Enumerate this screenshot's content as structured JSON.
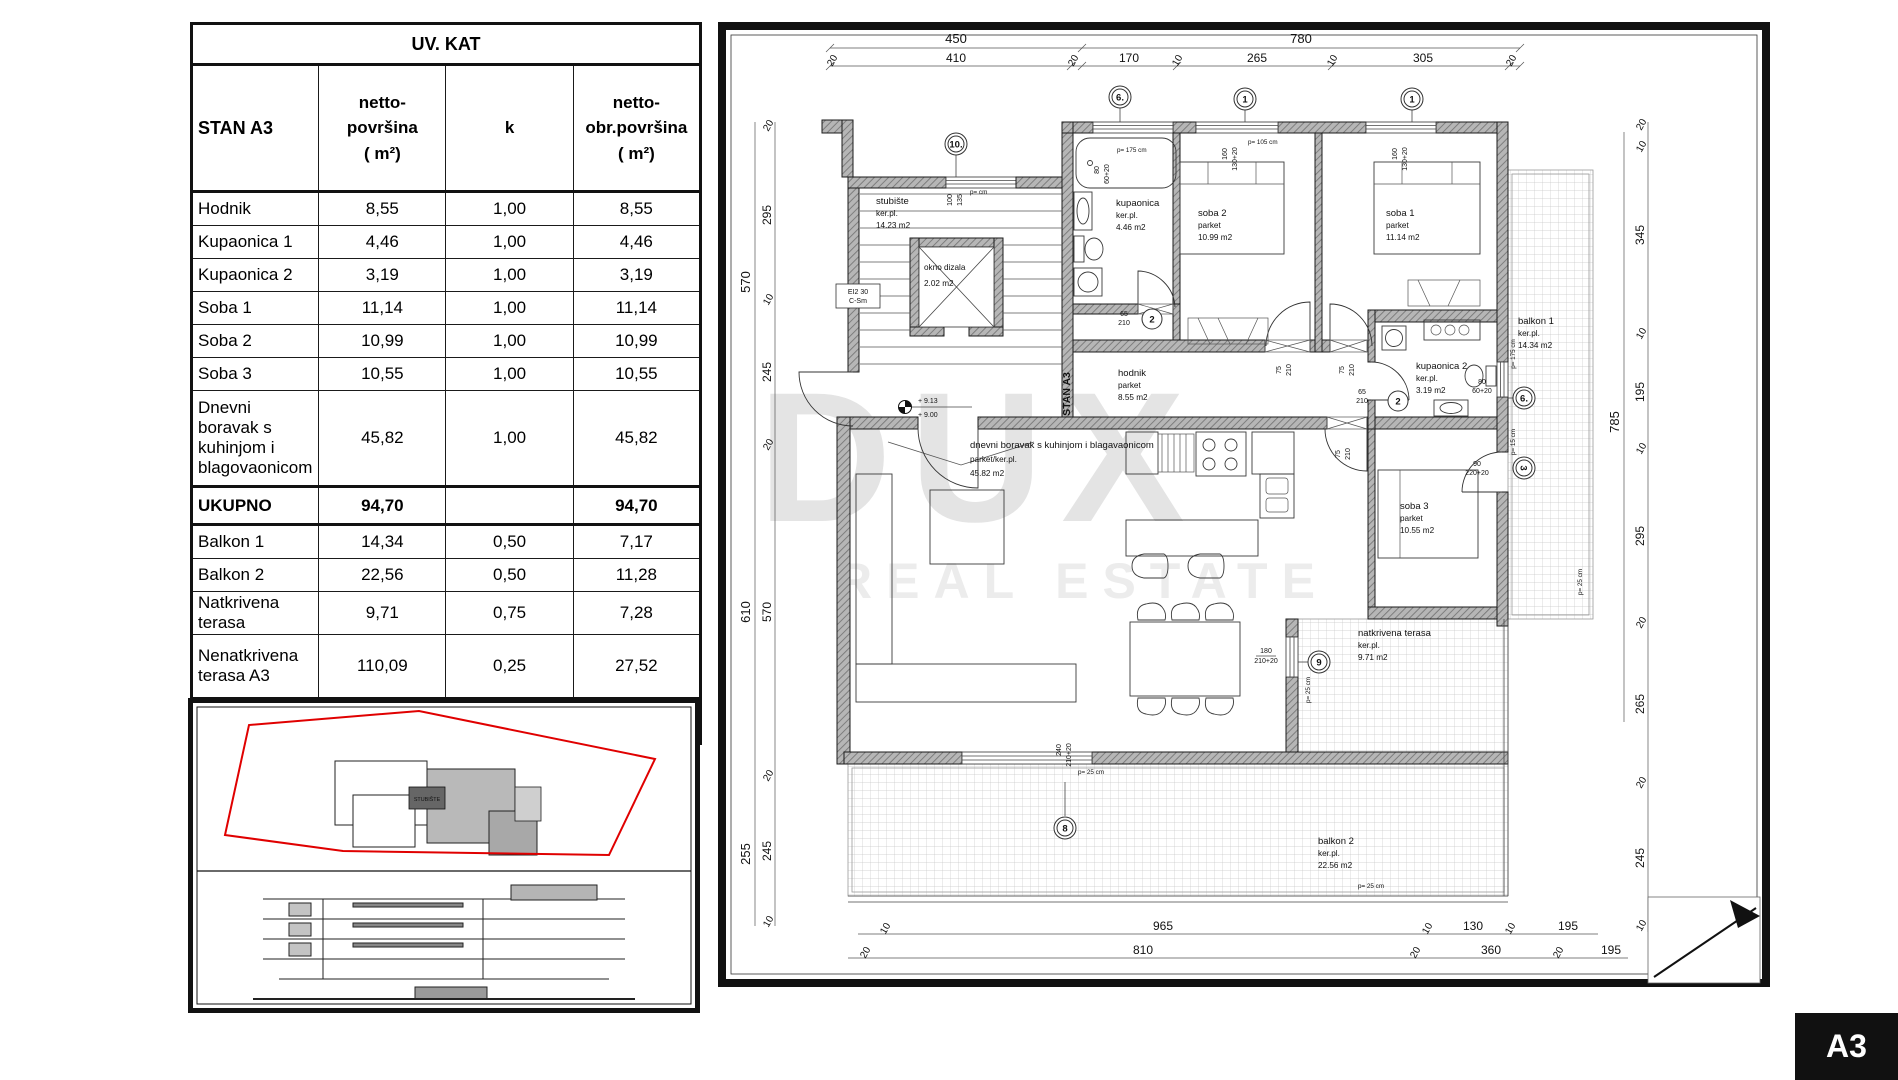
{
  "table": {
    "title": "UV. KAT",
    "header": {
      "name": "STAN A3",
      "c1": "netto-\npovršina\n( m²)",
      "c2": "k",
      "c3": "netto-\nobr.površina\n( m²)"
    },
    "rows": [
      {
        "label": "Hodnik",
        "netto": "8,55",
        "k": "1,00",
        "obr": "8,55"
      },
      {
        "label": "Kupaonica 1",
        "netto": "4,46",
        "k": "1,00",
        "obr": "4,46"
      },
      {
        "label": "Kupaonica 2",
        "netto": "3,19",
        "k": "1,00",
        "obr": "3,19"
      },
      {
        "label": "Soba 1",
        "netto": "11,14",
        "k": "1,00",
        "obr": "11,14"
      },
      {
        "label": "Soba 2",
        "netto": "10,99",
        "k": "1,00",
        "obr": "10,99"
      },
      {
        "label": "Soba 3",
        "netto": "10,55",
        "k": "1,00",
        "obr": "10,55"
      },
      {
        "label": "Dnevni boravak s kuhinjom i blagovaonicom",
        "netto": "45,82",
        "k": "1,00",
        "obr": "45,82"
      },
      {
        "label": "UKUPNO",
        "netto": "94,70",
        "k": "",
        "obr": "94,70"
      },
      {
        "label": "Balkon 1",
        "netto": "14,34",
        "k": "0,50",
        "obr": "7,17"
      },
      {
        "label": "Balkon 2",
        "netto": "22,56",
        "k": "0,50",
        "obr": "11,28"
      },
      {
        "label": "Natkrivena terasa",
        "netto": "9,71",
        "k": "0,75",
        "obr": "7,28"
      },
      {
        "label": "Nenatkrivena terasa A3",
        "netto": "110,09",
        "k": "0,25",
        "obr": "27,52"
      },
      {
        "label": "STAN A3 UKUPNO",
        "netto": "251,40",
        "k": "",
        "obr": "147,96"
      }
    ]
  },
  "plan": {
    "rooms": {
      "stubiste": {
        "name": "stubište",
        "floor": "ker.pl.",
        "area": "14.23    m2"
      },
      "dizalo": {
        "name": "okno dizala",
        "area": "2.02        m2"
      },
      "kupaonica1": {
        "name": "kupaonica",
        "floor": "ker.pl.",
        "area": "4.46      m2"
      },
      "soba2": {
        "name": "soba 2",
        "floor": "parket",
        "area": "10.99     m2"
      },
      "soba1": {
        "name": "soba 1",
        "floor": "parket",
        "area": "11.14     m2"
      },
      "balkon1": {
        "name": "balkon 1",
        "floor": "ker.pl.",
        "area": "14.34    m2"
      },
      "hodnik": {
        "name": "hodnik",
        "floor": "parket",
        "area": "8.55      m2"
      },
      "kupaonica2": {
        "name": "kupaonica 2",
        "floor": "ker.pl.",
        "area": "3.19      m2"
      },
      "soba3": {
        "name": "soba 3",
        "floor": "parket",
        "area": "10.55     m2"
      },
      "dnevni": {
        "name": "dnevni boravak s kuhinjom i blagavaonicom",
        "floor": "parket/ker.pl.",
        "area": "45.82     m2"
      },
      "terasa": {
        "name": "natkrivena terasa",
        "floor": "ker.pl.",
        "area": "9.71      m2"
      },
      "balkon2": {
        "name": "balkon 2",
        "floor": "ker.pl.",
        "area": "22.56    m2"
      }
    },
    "labels": {
      "stan": "STAN A3",
      "fire1": "EI2 30",
      "fire2": "C-Sm",
      "elev_up": "+ 9.13",
      "elev_dn": "+ 9.00"
    },
    "dims": {
      "top_outer": [
        "450",
        "780"
      ],
      "top_inner": [
        "20",
        "410",
        "20",
        "170",
        "10",
        "265",
        "10",
        "305",
        "20"
      ],
      "left_outer": [
        "570",
        "610",
        "255"
      ],
      "left_inner": [
        "20",
        "295",
        "10",
        "245",
        "20",
        "570",
        "20",
        "245",
        "10"
      ],
      "right_outer": [
        "785"
      ],
      "right_inner": [
        "20",
        "10",
        "345",
        "10",
        "195",
        "10",
        "295",
        "20",
        "265",
        "20",
        "245",
        "10"
      ],
      "bottom_upper": [
        "10",
        "965",
        "10",
        "130",
        "10",
        "195"
      ],
      "bottom_lower": [
        "20",
        "810",
        "20",
        "360",
        "20",
        "195"
      ]
    },
    "markers": {
      "m10": "10.",
      "m6a": "6.",
      "m1a": "1",
      "m1b": "1",
      "m2a": "2",
      "m2b": "2",
      "m6b": "6.",
      "m3": "3",
      "m9": "9",
      "m8": "8"
    },
    "openings": {
      "ws_a": "100",
      "ws_b": "135",
      "ws_p": "p= cm",
      "wk1_a": "80",
      "wk1_b": "60+20",
      "wk1_p": "p= 175 cm",
      "wsb_a": "160",
      "wsb_b": "130+20",
      "wsb_p": "p= 105 cm",
      "d75_a": "75",
      "d75_b": "210",
      "d65_a": "65",
      "d65_b": "210",
      "wt_a": "180",
      "wt_b": "210+20",
      "wl_a": "240",
      "wl_b": "210+20",
      "ws3_a": "90",
      "ws3_b": "220+20",
      "ws3_p": "p= 15 cm",
      "p25": "p= 25 cm"
    }
  },
  "site": {
    "stubiste": "STUBIŠTE"
  },
  "watermark": {
    "line1": "DUX",
    "line2": "REAL ESTATE"
  },
  "sheet_label": "A3"
}
